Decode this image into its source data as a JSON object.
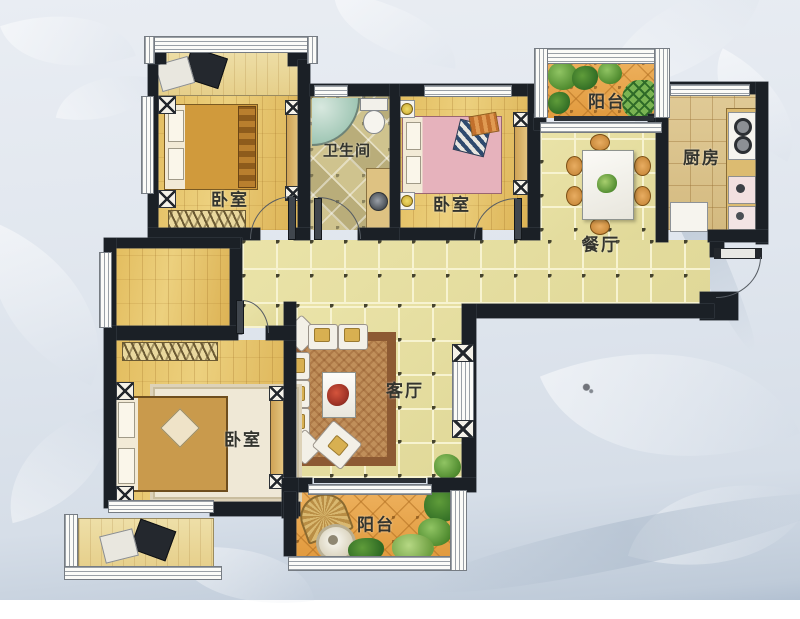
{
  "plan": {
    "type": "residential-floor-plan",
    "labels": {
      "bedroom_top_left": "卧室",
      "bathroom": "卫生间",
      "bedroom_top_right": "卧室",
      "balcony_top": "阳台",
      "kitchen": "厨房",
      "dining": "餐厅",
      "living": "客厅",
      "bedroom_master": "卧室",
      "balcony_bottom": "阳台"
    },
    "colors": {
      "wall": "#1b2026",
      "wood_floor": "#e0ba5c",
      "tile_floor": "#e7e0a2",
      "balcony_floor": "#e8a74e",
      "bath_floor": "#cdc28c",
      "kitchen_floor": "#dcc48d",
      "plant_green": "#4e8a2e",
      "background": "#dfe5ec"
    }
  }
}
